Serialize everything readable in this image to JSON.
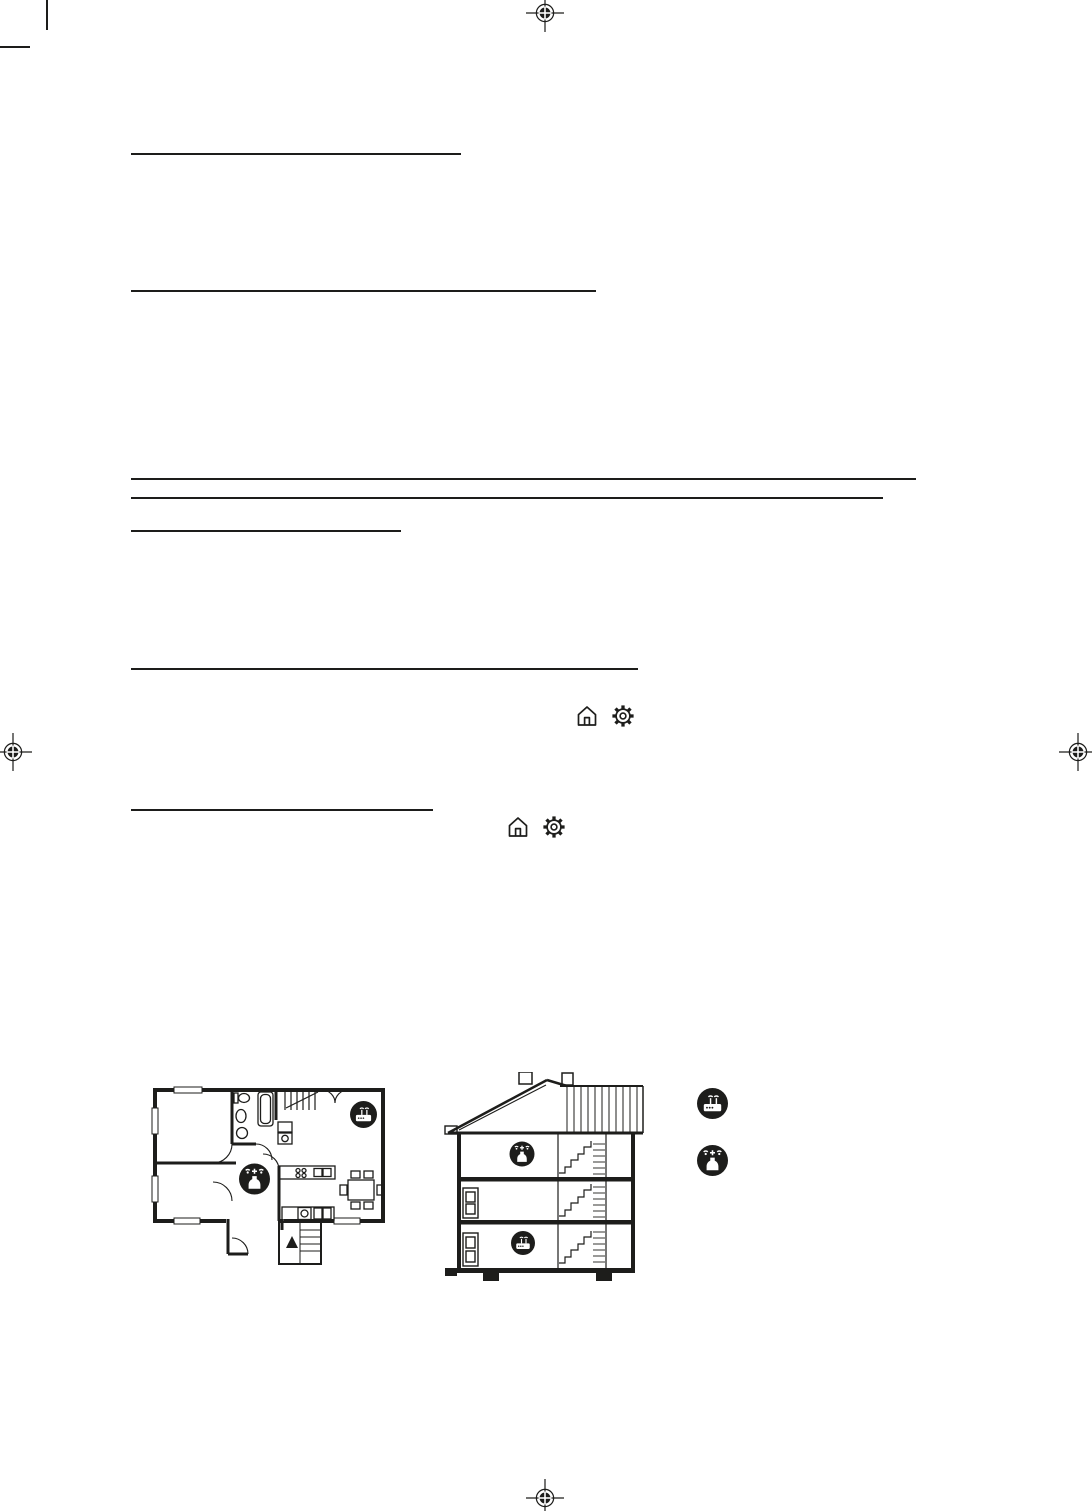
{
  "meta": {
    "page_kind": "scanned-print-manual-page",
    "background_color": "#ffffff",
    "ink_color": "#1d1d1b",
    "page_width": 1092,
    "page_height": 1511
  },
  "print_marks": {
    "crop_marks": [
      {
        "name": "crop-mark-top-left-vertical"
      },
      {
        "name": "crop-mark-top-left-horizontal"
      }
    ],
    "registration_marks": [
      {
        "name": "registration-mark-top",
        "x": 545,
        "y": 13
      },
      {
        "name": "registration-mark-left",
        "x": 13,
        "y": 752
      },
      {
        "name": "registration-mark-right",
        "x": 1078,
        "y": 752
      },
      {
        "name": "registration-mark-bottom",
        "x": 545,
        "y": 1498
      }
    ]
  },
  "content": {
    "heading_rules": [
      {
        "x": 131,
        "y": 153,
        "width": 330
      },
      {
        "x": 131,
        "y": 290,
        "width": 465
      },
      {
        "x": 131,
        "y": 478,
        "width": 785
      },
      {
        "x": 131,
        "y": 497,
        "width": 752
      },
      {
        "x": 131,
        "y": 530,
        "width": 270
      },
      {
        "x": 131,
        "y": 668,
        "width": 507
      },
      {
        "x": 131,
        "y": 809,
        "width": 302
      }
    ],
    "inline_icon_rows": [
      {
        "icons": [
          "home-icon",
          "settings-gear-icon"
        ],
        "x": 575,
        "y": 704
      },
      {
        "icons": [
          "home-icon",
          "settings-gear-icon"
        ],
        "x": 506,
        "y": 815
      }
    ]
  },
  "figures": {
    "floor_plan": {
      "name": "apartment-floor-plan",
      "devices": [
        {
          "icon": "wifi-extender-icon",
          "cx": 255,
          "cy": 1179
        },
        {
          "icon": "wifi-router-icon",
          "cx": 364,
          "cy": 1114
        }
      ]
    },
    "house_section": {
      "name": "house-cross-section",
      "devices": [
        {
          "icon": "wifi-extender-icon",
          "cx": 522,
          "cy": 1154
        },
        {
          "icon": "wifi-router-icon",
          "cx": 523,
          "cy": 1243
        }
      ]
    },
    "legend_icons": [
      {
        "icon": "wifi-router-icon",
        "x": 697,
        "y": 1088
      },
      {
        "icon": "wifi-extender-icon",
        "x": 697,
        "y": 1145
      }
    ]
  },
  "icon_glyphs": {
    "home-icon": "house outline",
    "settings-gear-icon": "cog outline",
    "wifi-router-icon": "router with two antennas inside filled circle",
    "wifi-extender-icon": "range extender with plus-signal inside filled circle",
    "registration-mark": "print registration target",
    "crop-mark": "corner trim line"
  }
}
